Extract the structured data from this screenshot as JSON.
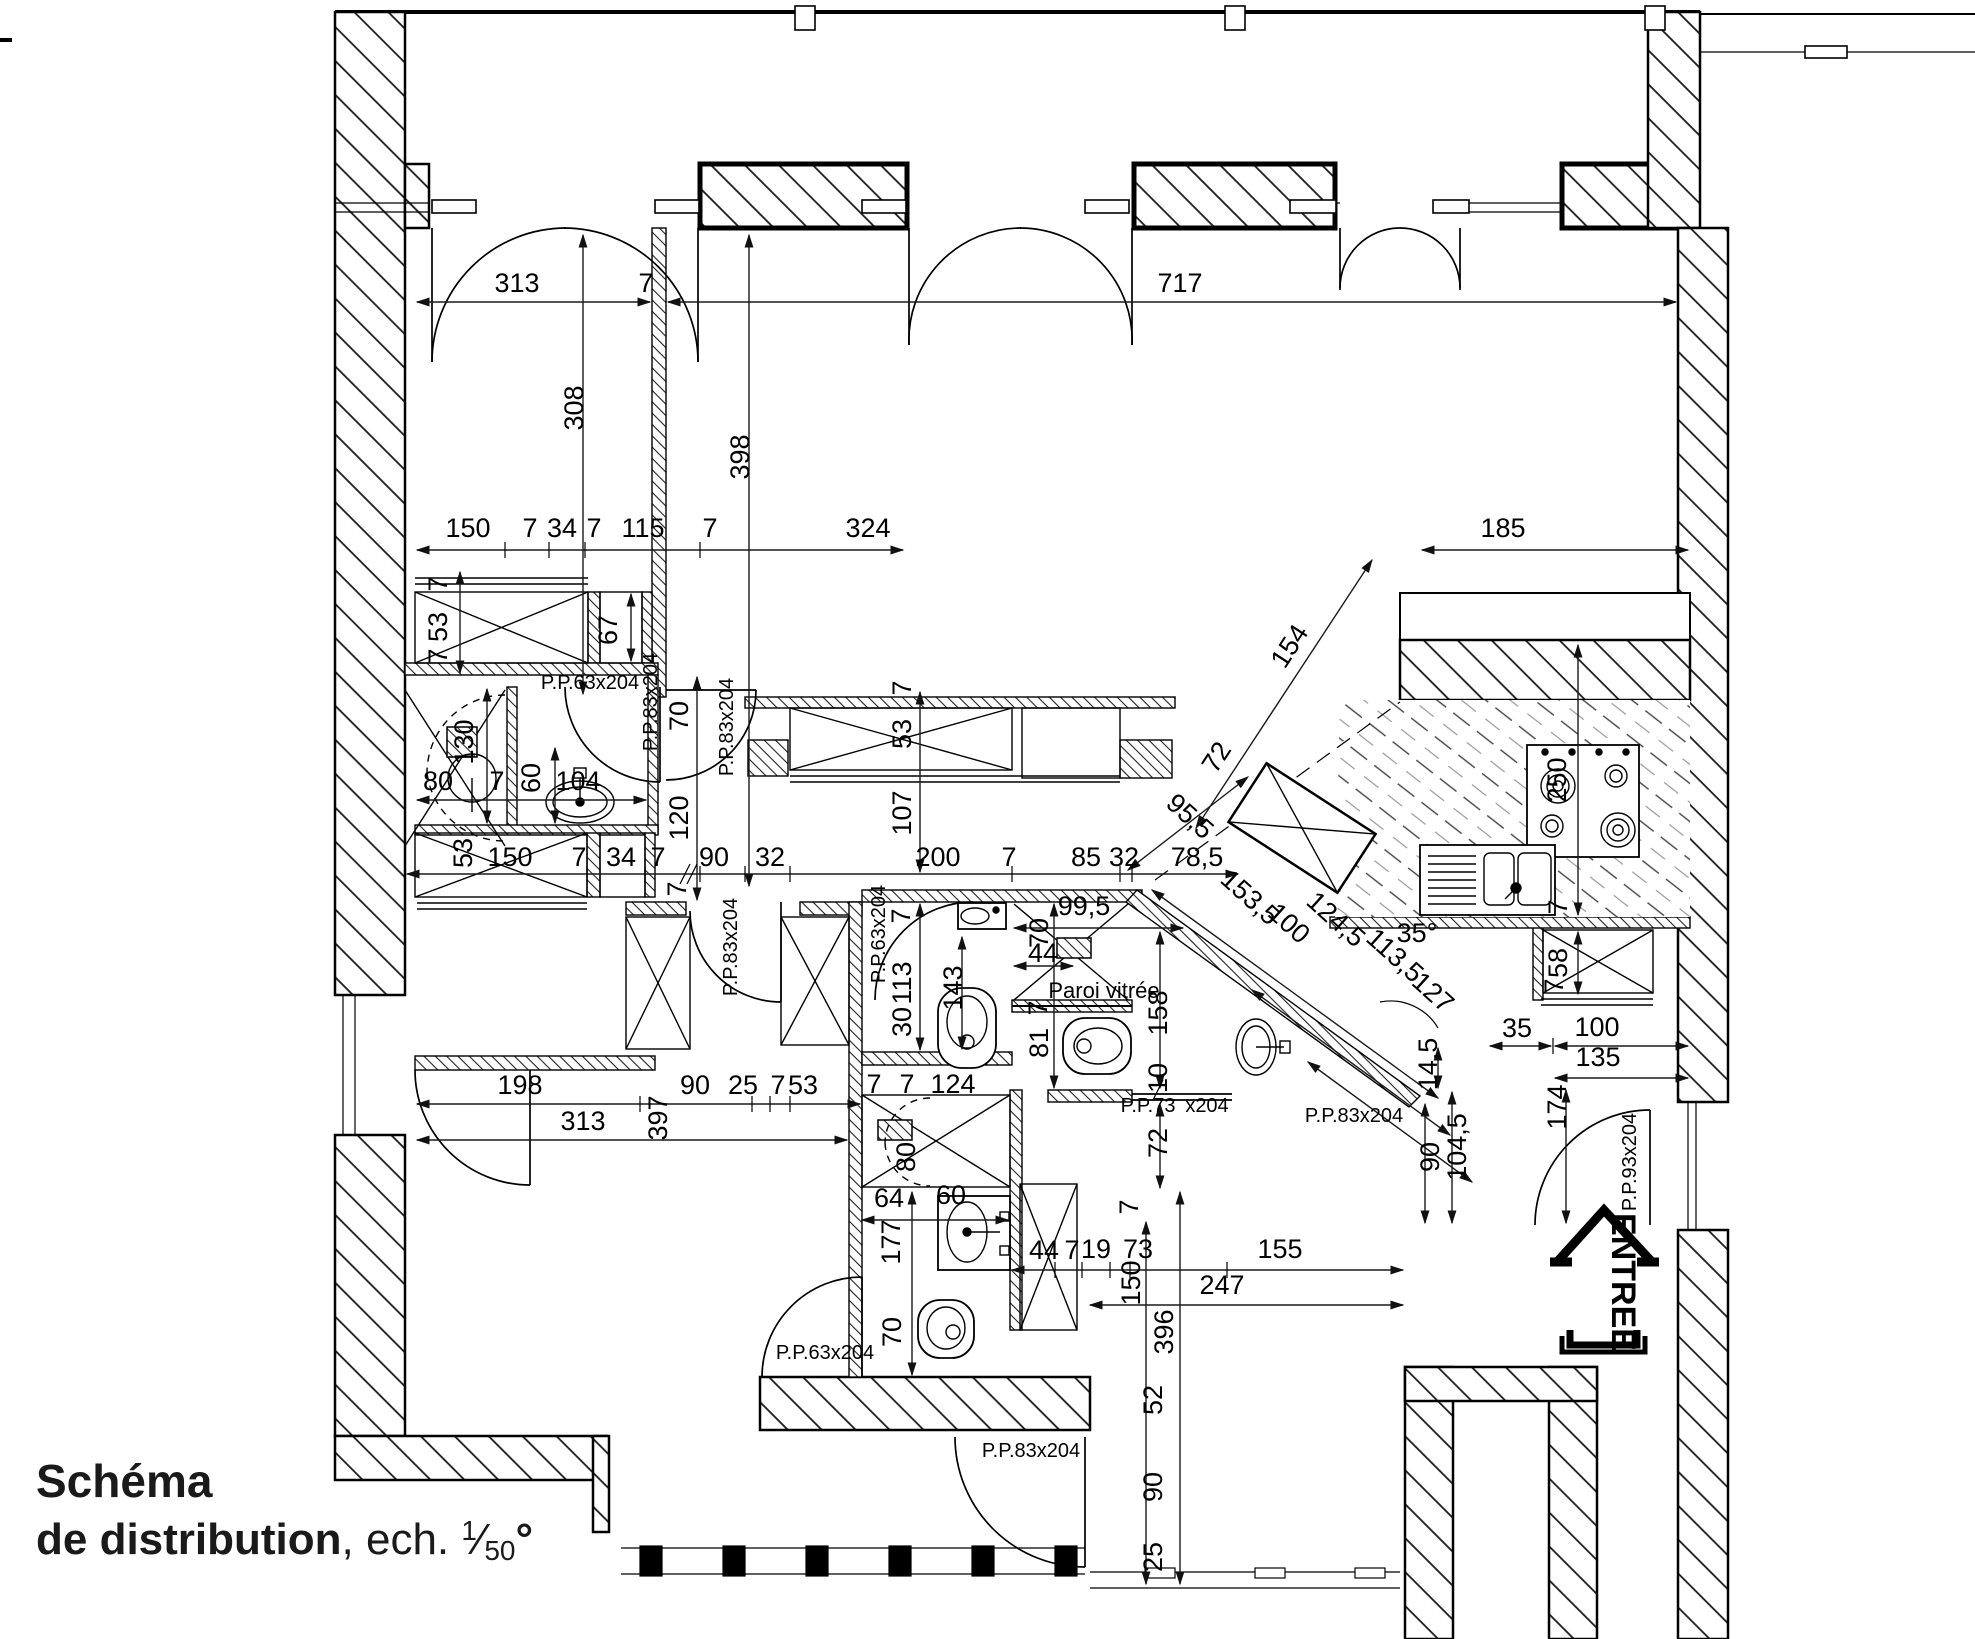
{
  "title": {
    "line1": "Schéma",
    "line2_bold": "de distribution",
    "line2_rest": ", ech. ",
    "scale_num": "1",
    "frac_slash": "⁄",
    "scale_den": "50",
    "degree": "°"
  },
  "colors": {
    "ink": "#000000",
    "paper": "#ffffff"
  },
  "labels": [
    {
      "t": "313",
      "x": 517,
      "y": 292
    },
    {
      "t": "7",
      "x": 646,
      "y": 292
    },
    {
      "t": "717",
      "x": 1180,
      "y": 292
    },
    {
      "t": "308",
      "x": 583,
      "y": 408,
      "r": -90
    },
    {
      "t": "398",
      "x": 749,
      "y": 457,
      "r": -90
    },
    {
      "t": "150",
      "x": 468,
      "y": 537
    },
    {
      "t": "7",
      "x": 530,
      "y": 537
    },
    {
      "t": "34",
      "x": 562,
      "y": 537
    },
    {
      "t": "7",
      "x": 594,
      "y": 537
    },
    {
      "t": "115",
      "x": 643,
      "y": 537
    },
    {
      "t": "7",
      "x": 710,
      "y": 537
    },
    {
      "t": "324",
      "x": 868,
      "y": 537
    },
    {
      "t": "185",
      "x": 1503,
      "y": 537
    },
    {
      "t": "7",
      "x": 447,
      "y": 584,
      "r": -90
    },
    {
      "t": "53",
      "x": 447,
      "y": 627,
      "r": -90
    },
    {
      "t": "7",
      "x": 447,
      "y": 656,
      "r": -90
    },
    {
      "t": "67",
      "x": 617,
      "y": 630,
      "r": -90
    },
    {
      "t": "70",
      "x": 688,
      "y": 716,
      "r": -90
    },
    {
      "t": "120",
      "x": 688,
      "y": 818,
      "r": -90
    },
    {
      "t": "7",
      "x": 911,
      "y": 688,
      "r": -90
    },
    {
      "t": "53",
      "x": 911,
      "y": 734,
      "r": -90
    },
    {
      "t": "107",
      "x": 911,
      "y": 813,
      "r": -90
    },
    {
      "t": "80",
      "x": 438,
      "y": 790
    },
    {
      "t": "130",
      "x": 473,
      "y": 742,
      "r": -90
    },
    {
      "t": "7",
      "x": 497,
      "y": 790
    },
    {
      "t": "60",
      "x": 540,
      "y": 778,
      "r": -90
    },
    {
      "t": "104",
      "x": 578,
      "y": 790
    },
    {
      "t": "53",
      "x": 472,
      "y": 853,
      "r": -90
    },
    {
      "t": "150",
      "x": 510,
      "y": 866
    },
    {
      "t": "7",
      "x": 579,
      "y": 866
    },
    {
      "t": "34",
      "x": 621,
      "y": 866
    },
    {
      "t": "7",
      "x": 658,
      "y": 866
    },
    {
      "t": "90",
      "x": 714,
      "y": 866
    },
    {
      "t": "32",
      "x": 770,
      "y": 866
    },
    {
      "t": "7",
      "x": 686,
      "y": 889,
      "r": -90
    },
    {
      "t": "200",
      "x": 938,
      "y": 866
    },
    {
      "t": "7",
      "x": 1009,
      "y": 866
    },
    {
      "t": "85",
      "x": 1086,
      "y": 866
    },
    {
      "t": "32",
      "x": 1124,
      "y": 866
    },
    {
      "t": "78,5",
      "x": 1197,
      "y": 866
    },
    {
      "t": "95,5",
      "x": 1184,
      "y": 823,
      "r": 42
    },
    {
      "t": "153,5",
      "x": 1244,
      "y": 904,
      "r": 42
    },
    {
      "t": "100",
      "x": 1283,
      "y": 930,
      "r": 42
    },
    {
      "t": "124,5",
      "x": 1330,
      "y": 926,
      "r": 42
    },
    {
      "t": "113,5",
      "x": 1389,
      "y": 962,
      "r": 42
    },
    {
      "t": "127",
      "x": 1427,
      "y": 999,
      "r": 42
    },
    {
      "t": "35°",
      "x": 1417,
      "y": 942
    },
    {
      "t": "154",
      "x": 1297,
      "y": 651,
      "r": -57
    },
    {
      "t": "72",
      "x": 1224,
      "y": 762,
      "r": -57
    },
    {
      "t": "250",
      "x": 1566,
      "y": 780,
      "r": -90
    },
    {
      "t": "7",
      "x": 1567,
      "y": 907,
      "r": -90
    },
    {
      "t": "58",
      "x": 1567,
      "y": 963,
      "r": -90
    },
    {
      "t": "7",
      "x": 1563,
      "y": 986,
      "r": -90
    },
    {
      "t": "35",
      "x": 1517,
      "y": 1037
    },
    {
      "t": "100",
      "x": 1597,
      "y": 1036
    },
    {
      "t": "135",
      "x": 1598,
      "y": 1066
    },
    {
      "t": "14,5",
      "x": 1437,
      "y": 1064,
      "r": -90
    },
    {
      "t": "174",
      "x": 1566,
      "y": 1107,
      "r": -90
    },
    {
      "t": "104,5",
      "x": 1466,
      "y": 1147,
      "r": -90
    },
    {
      "t": "90",
      "x": 1439,
      "y": 1157,
      "r": -90
    },
    {
      "t": "7",
      "x": 910,
      "y": 916,
      "r": -90
    },
    {
      "t": "113",
      "x": 911,
      "y": 983,
      "r": -90
    },
    {
      "t": "30",
      "x": 911,
      "y": 1022,
      "r": -90
    },
    {
      "t": "143",
      "x": 962,
      "y": 988,
      "r": -90
    },
    {
      "t": "99,5",
      "x": 1084,
      "y": 915
    },
    {
      "t": "70",
      "x": 1048,
      "y": 933,
      "r": -90
    },
    {
      "t": "44",
      "x": 1043,
      "y": 962
    },
    {
      "t": "7",
      "x": 1047,
      "y": 1008,
      "r": -90
    },
    {
      "t": "81",
      "x": 1048,
      "y": 1043,
      "r": -90
    },
    {
      "t": "158",
      "x": 1167,
      "y": 1013,
      "r": -90
    },
    {
      "t": "10",
      "x": 1167,
      "y": 1078,
      "r": -90
    },
    {
      "t": "72",
      "x": 1167,
      "y": 1143,
      "r": -90
    },
    {
      "t": "7",
      "x": 874,
      "y": 1093
    },
    {
      "t": "7",
      "x": 907,
      "y": 1093
    },
    {
      "t": "124",
      "x": 953,
      "y": 1093
    },
    {
      "t": "80",
      "x": 915,
      "y": 1157,
      "r": -90
    },
    {
      "t": "198",
      "x": 520,
      "y": 1094
    },
    {
      "t": "90",
      "x": 695,
      "y": 1094
    },
    {
      "t": "25",
      "x": 743,
      "y": 1094
    },
    {
      "t": "7",
      "x": 778,
      "y": 1094
    },
    {
      "t": "53",
      "x": 803,
      "y": 1094
    },
    {
      "t": "313",
      "x": 583,
      "y": 1130
    },
    {
      "t": "397",
      "x": 667,
      "y": 1118,
      "r": -90
    },
    {
      "t": "64",
      "x": 889,
      "y": 1207
    },
    {
      "t": "60",
      "x": 951,
      "y": 1204
    },
    {
      "t": "177",
      "x": 900,
      "y": 1242,
      "r": -90
    },
    {
      "t": "70",
      "x": 901,
      "y": 1332,
      "r": -90
    },
    {
      "t": "44",
      "x": 1044,
      "y": 1259
    },
    {
      "t": "7",
      "x": 1072,
      "y": 1259
    },
    {
      "t": "19",
      "x": 1096,
      "y": 1258
    },
    {
      "t": "73",
      "x": 1138,
      "y": 1258
    },
    {
      "t": "155",
      "x": 1280,
      "y": 1258
    },
    {
      "t": "150",
      "x": 1140,
      "y": 1283,
      "r": -90
    },
    {
      "t": "247",
      "x": 1222,
      "y": 1294
    },
    {
      "t": "396",
      "x": 1173,
      "y": 1332,
      "r": -90
    },
    {
      "t": "7",
      "x": 1138,
      "y": 1207,
      "r": -90
    },
    {
      "t": "52",
      "x": 1162,
      "y": 1400,
      "r": -90
    },
    {
      "t": "90",
      "x": 1162,
      "y": 1487,
      "r": -90
    },
    {
      "t": "25",
      "x": 1162,
      "y": 1557,
      "r": -90
    },
    {
      "t": "P.P.63x204",
      "x": 590,
      "y": 689,
      "s": 20,
      "n": "door-label"
    },
    {
      "t": "P.P.83x204",
      "x": 657,
      "y": 702,
      "r": -90,
      "s": 20,
      "n": "door-label"
    },
    {
      "t": "P.P.83x204",
      "x": 733,
      "y": 727,
      "r": -90,
      "s": 20,
      "n": "door-label"
    },
    {
      "t": "P.P.83x204",
      "x": 737,
      "y": 947,
      "r": -90,
      "s": 20,
      "n": "door-label"
    },
    {
      "t": "P.P.63x204",
      "x": 885,
      "y": 934,
      "r": -90,
      "s": 20,
      "n": "door-label"
    },
    {
      "t": "P.P.73",
      "x": 1148,
      "y": 1112,
      "s": 20,
      "n": "door-label"
    },
    {
      "t": "x204",
      "x": 1207,
      "y": 1112,
      "s": 20,
      "n": "door-label"
    },
    {
      "t": "P.P.83x204",
      "x": 1354,
      "y": 1122,
      "s": 20,
      "n": "door-label"
    },
    {
      "t": "P.P.93x204",
      "x": 1636,
      "y": 1162,
      "r": -90,
      "s": 20,
      "n": "door-label"
    },
    {
      "t": "P.P.63x204",
      "x": 825,
      "y": 1359,
      "s": 20,
      "n": "door-label"
    },
    {
      "t": "P.P.83x204",
      "x": 1031,
      "y": 1457,
      "s": 20,
      "n": "door-label"
    },
    {
      "t": "Paroi vitrée",
      "x": 1104,
      "y": 998,
      "s": 22,
      "n": "glass-wall-label"
    },
    {
      "t": "ENTREE",
      "x": 1612,
      "y": 1282,
      "r": 90,
      "s": 34,
      "b": 1,
      "n": "entrance-label"
    }
  ]
}
